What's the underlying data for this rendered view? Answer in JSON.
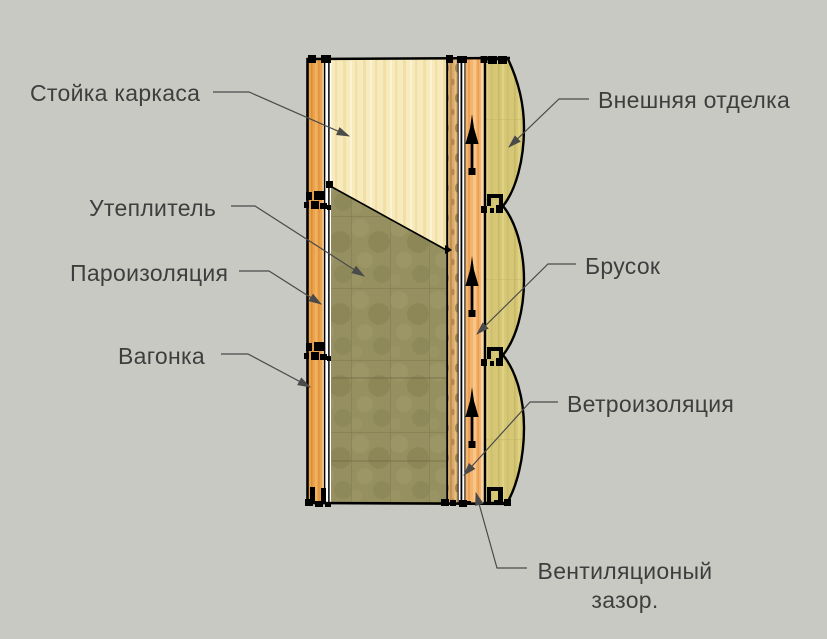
{
  "diagram": {
    "type": "wall-section",
    "layers_inside_to_outside": [
      "Вагонка",
      "Пароизоляция",
      "Стойка каркаса",
      "Утеплитель",
      "Ветроизоляция",
      "Брусок",
      "Вентиляционый зазор.",
      "Внешняя отделка"
    ]
  },
  "labels": {
    "stud": "Стойка каркаса",
    "insulation": "Утеплитель",
    "vapor_barrier": "Пароизоляция",
    "lining": "Вагонка",
    "exterior_finish": "Внешняя отделка",
    "batten": "Брусок",
    "wind_barrier": "Ветроизоляция",
    "vent_gap_line1": "Вентиляционый",
    "vent_gap_line2": "зазор."
  },
  "colors": {
    "background": "#c9c9c4",
    "outline": "#000000",
    "label_text": "#3e3e3e",
    "leader_line": "#4a4a4a",
    "lining_wood": "#eba24b",
    "lining_highlight": "#f7c77e",
    "lining_shadow": "#d08a35",
    "stud_wood": "#f7eabd",
    "stud_streak": "#efdc9e",
    "insulation_wool": "#969060",
    "insulation_light": "#a49e70",
    "insulation_dark": "#7f7a4a",
    "rough_batten_wood": "#d8ab6c",
    "rough_batten_knot": "#8a6434",
    "batten_wood": "#f5b46e",
    "batten_highlight": "#fdd6a2",
    "siding_wood": "#d6c776",
    "siding_streak": "#c4b662",
    "airflow_arrow": "#000000"
  }
}
